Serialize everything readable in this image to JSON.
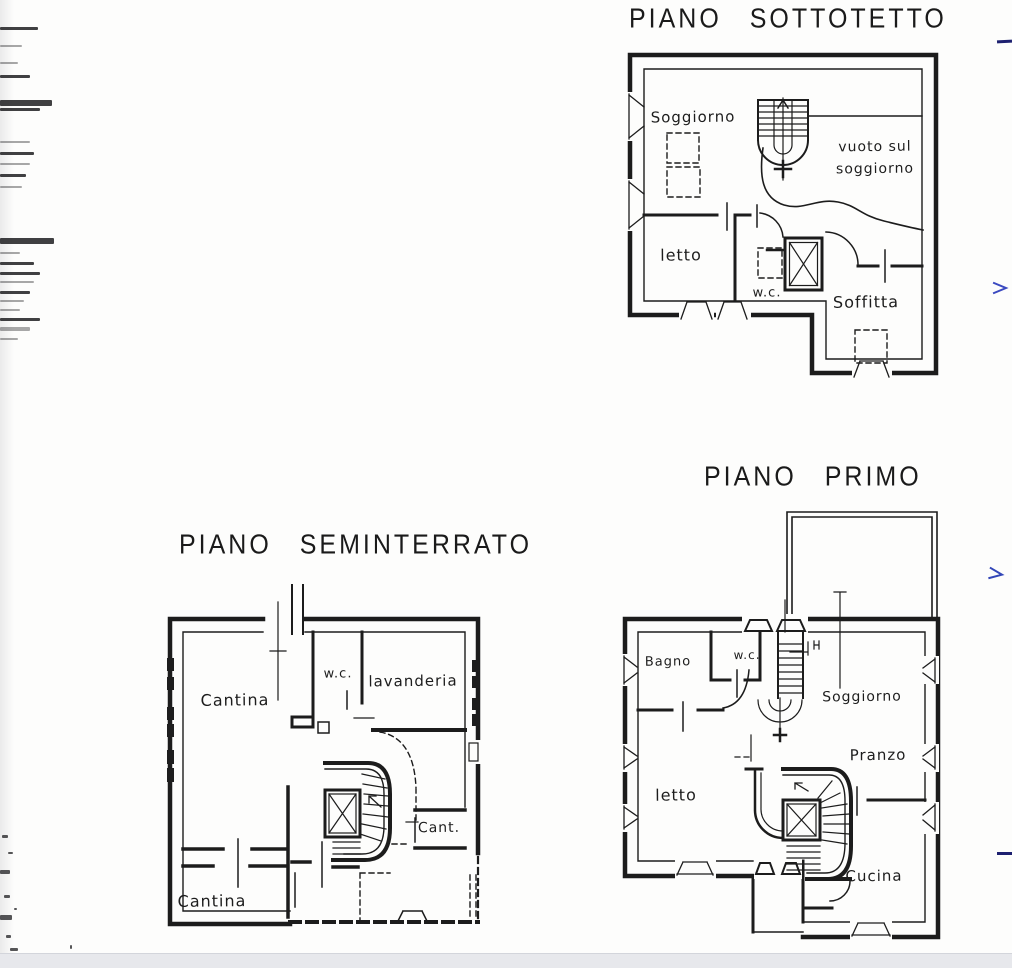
{
  "colors": {
    "ink": "#1c1c1c",
    "paper": "#fdfdfc",
    "scan_strip": "#e7e8ec",
    "annotation_blue": "#2c3cae"
  },
  "plans": {
    "sottotetto": {
      "title": "PIANO SOTTOTETTO",
      "rooms": {
        "soggiorno": "Soggiorno",
        "vuoto_line1": "vuoto sul",
        "vuoto_line2": "soggiorno",
        "letto": "letto",
        "wc": "w.c.",
        "soffitta": "Soffitta"
      }
    },
    "seminterrato": {
      "title": "PIANO SEMINTERRATO",
      "rooms": {
        "cantina_nord": "Cantina",
        "wc": "w.c.",
        "lavanderia": "lavanderia",
        "cant": "Cant.",
        "cantina_sud": "Cantina"
      }
    },
    "primo": {
      "title": "PIANO PRIMO",
      "rooms": {
        "bagno": "Bagno",
        "wc": "w.c.",
        "soggiorno": "Soggiorno",
        "pranzo": "Pranzo",
        "letto": "letto",
        "cucina": "Cucina"
      }
    }
  }
}
